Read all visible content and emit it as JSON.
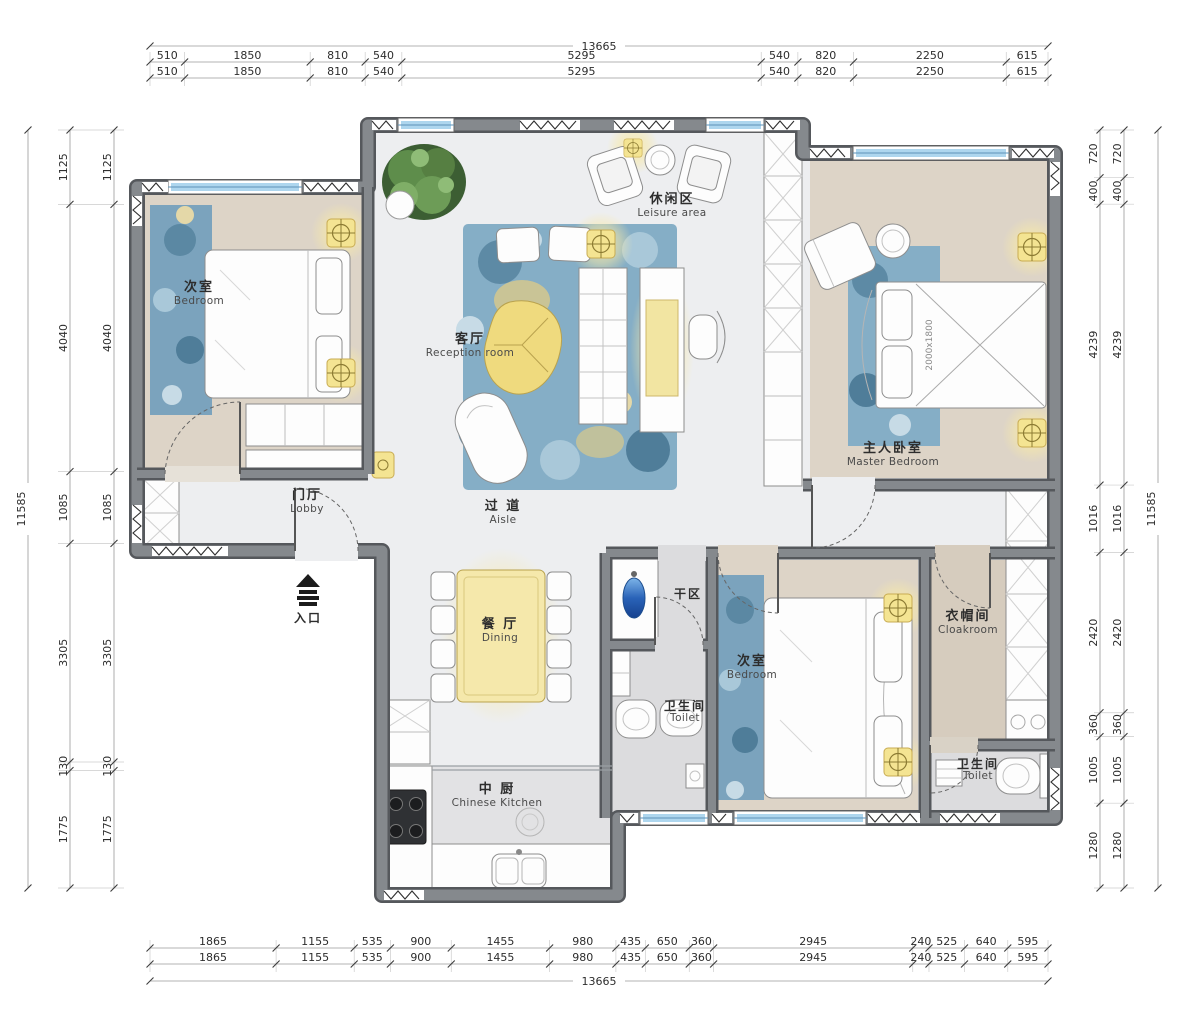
{
  "plan_title": "apartment-floor-plan",
  "rooms": {
    "bedroom1": {
      "cn": "次室",
      "en": "Bedroom"
    },
    "leisure": {
      "cn": "休闲区",
      "en": "Leisure area"
    },
    "reception": {
      "cn": "客厅",
      "en": "Reception  room"
    },
    "master": {
      "cn": "主人卧室",
      "en": "Master Bedroom"
    },
    "lobby": {
      "cn": "门厅",
      "en": "Lobby"
    },
    "aisle": {
      "cn": "过 道",
      "en": "Aisle"
    },
    "dry_area": {
      "cn": "干区",
      "en": ""
    },
    "dining": {
      "cn": "餐 厅",
      "en": "Dining"
    },
    "bedroom2": {
      "cn": "次室",
      "en": "Bedroom"
    },
    "cloakroom": {
      "cn": "衣帽间",
      "en": "Cloakroom"
    },
    "toilet1": {
      "cn": "卫生间",
      "en": "Toilet"
    },
    "toilet2": {
      "cn": "卫生间",
      "en": "Toilet"
    },
    "kitchen": {
      "cn": "中 厨",
      "en": "Chinese Kitchen"
    },
    "entrance": {
      "cn": "入口",
      "en": ""
    }
  },
  "annotations": {
    "master_bed_size": "2000x1800"
  },
  "dimensions": {
    "overall_width": "13665",
    "overall_height": "11585",
    "top": [
      "510",
      "1850",
      "810",
      "540",
      "5295",
      "540",
      "820",
      "2250",
      "615"
    ],
    "bottom": [
      "1865",
      "1155",
      "535",
      "900",
      "1455",
      "980",
      "435",
      "650",
      "360",
      "2945",
      "240",
      "525",
      "640",
      "595"
    ],
    "left": [
      "1125",
      "4040",
      "1085",
      "3305",
      "130",
      "1775"
    ],
    "right": [
      "720",
      "400",
      "4239",
      "1016",
      "2420",
      "360",
      "1005",
      "1280"
    ]
  },
  "colors": {
    "wall": "#85898d",
    "wall_edge": "#55585c",
    "window_glass": "#aed6ee",
    "floor_marble": "#edeef0",
    "floor_wood": "#ddd4c7",
    "accent_light": "#f4e492",
    "rug_blue": "#85aec6",
    "sink_blue": "#2a63b8",
    "tree_green": "#46703a"
  }
}
